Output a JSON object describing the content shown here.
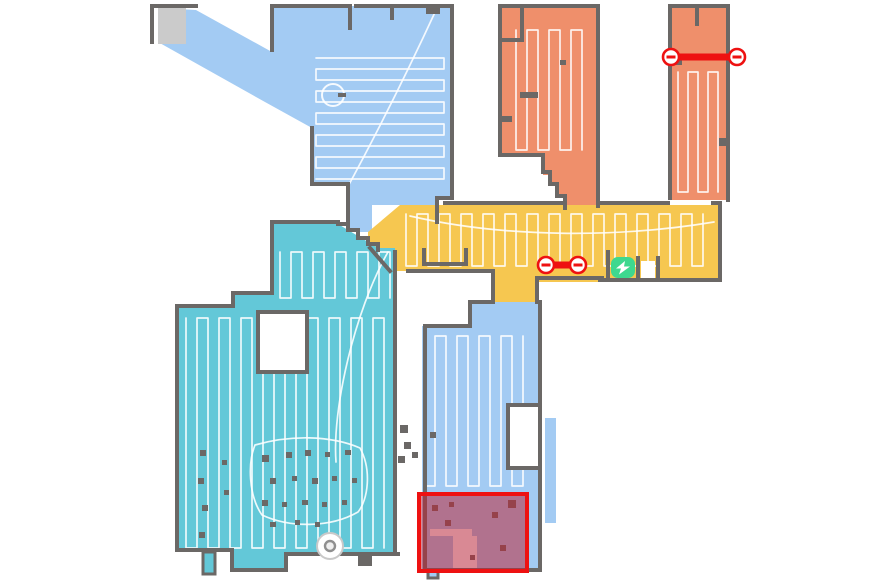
{
  "app": {
    "name": "robot-vacuum-map"
  },
  "colors": {
    "blue": "#a3cbf3",
    "teal": "#63c8d8",
    "orange": "#ef8f6b",
    "yellow": "#f6c750",
    "wall": "#6b6866",
    "unexplored": "#cbcbcb",
    "trace": "#ffffff",
    "red": "#ee1111",
    "nogo_fill": "rgba(190,33,50,0.52)",
    "green": "#3ed88f",
    "background": "#ffffff"
  },
  "rooms": [
    {
      "id": "room-top-left",
      "color": "blue"
    },
    {
      "id": "room-top-middle",
      "color": "orange"
    },
    {
      "id": "room-top-right",
      "color": "orange"
    },
    {
      "id": "room-corridor",
      "color": "yellow"
    },
    {
      "id": "room-left",
      "color": "teal"
    },
    {
      "id": "room-bottom",
      "color": "blue"
    }
  ],
  "traces": [
    {
      "room": "room-top-left",
      "x": 316,
      "y": 58,
      "w": 128,
      "h": 124,
      "dir": "h",
      "gap": 11
    },
    {
      "room": "room-top-middle",
      "x": 516,
      "y": 30,
      "w": 72,
      "h": 120,
      "dir": "v",
      "gap": 11
    },
    {
      "room": "room-top-right",
      "x": 678,
      "y": 72,
      "w": 44,
      "h": 120,
      "dir": "v",
      "gap": 10
    },
    {
      "room": "room-corridor",
      "x": 406,
      "y": 214,
      "w": 306,
      "h": 52,
      "dir": "v",
      "gap": 11
    },
    {
      "room": "room-left-upper",
      "x": 280,
      "y": 252,
      "w": 112,
      "h": 46,
      "dir": "v",
      "gap": 11
    },
    {
      "room": "room-left-main",
      "x": 186,
      "y": 318,
      "w": 204,
      "h": 230,
      "dir": "v",
      "gap": 11
    },
    {
      "room": "room-bottom",
      "x": 424,
      "y": 336,
      "w": 104,
      "h": 150,
      "dir": "v",
      "gap": 11
    }
  ],
  "obstacles": [
    [
      262,
      455,
      7,
      7
    ],
    [
      286,
      452,
      6,
      6
    ],
    [
      305,
      450,
      6,
      6
    ],
    [
      325,
      452,
      5,
      5
    ],
    [
      345,
      450,
      6,
      5
    ],
    [
      270,
      478,
      6,
      6
    ],
    [
      292,
      476,
      5,
      5
    ],
    [
      312,
      478,
      6,
      6
    ],
    [
      332,
      476,
      5,
      5
    ],
    [
      352,
      478,
      5,
      5
    ],
    [
      262,
      500,
      6,
      6
    ],
    [
      282,
      502,
      5,
      5
    ],
    [
      302,
      500,
      6,
      5
    ],
    [
      322,
      502,
      5,
      5
    ],
    [
      342,
      500,
      5,
      5
    ],
    [
      270,
      522,
      6,
      5
    ],
    [
      295,
      520,
      5,
      5
    ],
    [
      315,
      522,
      5,
      5
    ],
    [
      200,
      450,
      6,
      6
    ],
    [
      198,
      478,
      6,
      6
    ],
    [
      202,
      505,
      6,
      6
    ],
    [
      199,
      532,
      6,
      6
    ],
    [
      222,
      460,
      5,
      5
    ],
    [
      224,
      490,
      5,
      5
    ],
    [
      358,
      556,
      14,
      10
    ],
    [
      338,
      93,
      8,
      4
    ],
    [
      400,
      425,
      8,
      8
    ],
    [
      404,
      442,
      7,
      7
    ],
    [
      398,
      456,
      7,
      7
    ],
    [
      412,
      452,
      6,
      6
    ],
    [
      430,
      432,
      6,
      6
    ],
    [
      432,
      505,
      6,
      6
    ],
    [
      449,
      502,
      5,
      5
    ],
    [
      445,
      520,
      6,
      6
    ],
    [
      492,
      512,
      6,
      6
    ],
    [
      470,
      555,
      5,
      5
    ],
    [
      500,
      545,
      6,
      6
    ],
    [
      508,
      500,
      8,
      8
    ],
    [
      520,
      92,
      18,
      6
    ],
    [
      500,
      116,
      12,
      6
    ],
    [
      560,
      60,
      6,
      5
    ],
    [
      719,
      138,
      9,
      8
    ],
    [
      676,
      60,
      6,
      5
    ]
  ],
  "no_go_zone": {
    "x": 419,
    "y": 494,
    "width": 108,
    "height": 77
  },
  "virtual_walls": [
    {
      "x1": 671,
      "y1": 57,
      "x2": 737,
      "y2": 57
    },
    {
      "x1": 546,
      "y1": 265,
      "x2": 578,
      "y2": 265
    }
  ],
  "dock": {
    "x": 611,
    "y": 257,
    "width": 24,
    "height": 21,
    "icon": "charging-bolt-icon"
  },
  "robot": {
    "cx": 330,
    "cy": 546,
    "r": 13
  }
}
